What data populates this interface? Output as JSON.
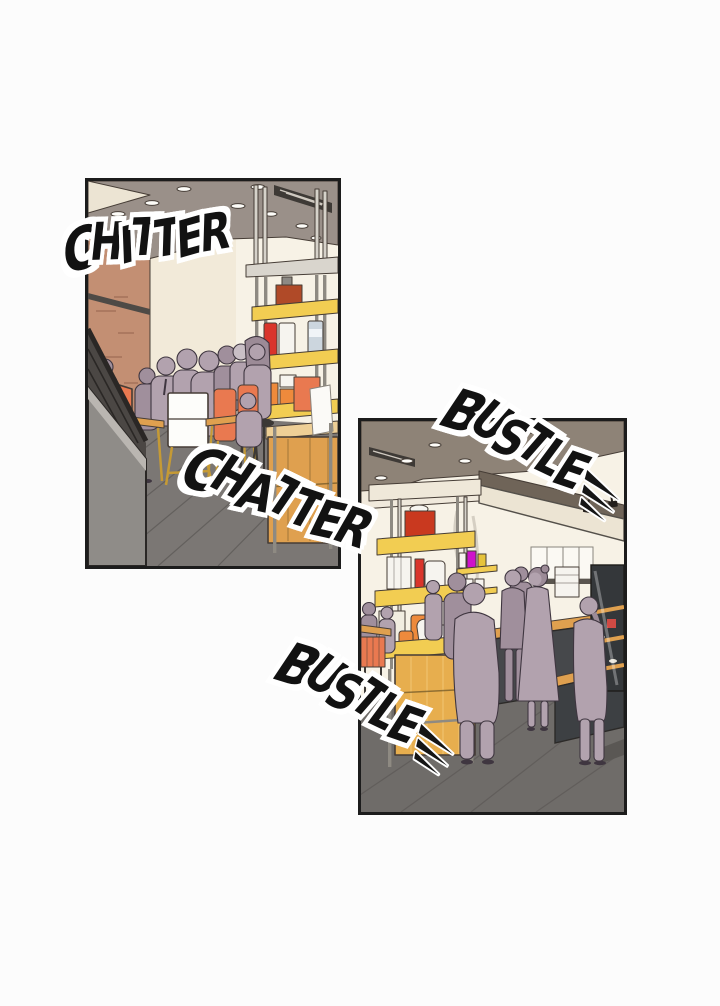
{
  "page": {
    "background": "#fcfcfc"
  },
  "panels": [
    {
      "id": "seating",
      "sfx_top": "CHITTER",
      "sfx_bottom": "CHATTER"
    },
    {
      "id": "counter",
      "sfx_top": "BUSTLE",
      "sfx_bottom": "BUSTLE"
    }
  ],
  "icons": {
    "speed_lines": "speed-lines-icon",
    "spotlight": "spotlight-icon"
  },
  "palette": {
    "page_bg": "#fcfcfc",
    "ink": "#1c1c1c",
    "line": "#463d36",
    "ceilA": "#9a9089",
    "ceilB": "#8e8377",
    "brick": "#c38f73",
    "brickline": "#9c6b53",
    "cream": "#f2ead9",
    "creamlight": "#f7f2e6",
    "beam": "#ece4d3",
    "vent": "#3e3a36",
    "floorA": "#7b7774",
    "floorB": "#6f6c69",
    "floorline": "#5e5a57",
    "people": "#b2a2ae",
    "peopledark": "#a08f9c",
    "peopleline": "#3f3640",
    "hairgray": "#c9bfc6",
    "hairplum": "#9c8b97",
    "orange": "#e97950",
    "wood": "#dfa04f",
    "woodlight": "#eecf96",
    "wooddark": "#6b5426",
    "yellow": "#f2cd52",
    "poleL": "#d6d2ca",
    "poleD": "#8e8a82",
    "red": "#d9352b",
    "reddark": "#b04a28",
    "bluegray": "#ccd6de",
    "orangeitem": "#ee8a3c",
    "magenta": "#cf12cb",
    "whiteitem": "#f6f4ef",
    "counterdark": "#46484b",
    "counterdark2": "#3d4043",
    "rail": "#2a2725",
    "balwall": "#8f8c88",
    "brass": "#c59a35",
    "white": "#fdfdfa",
    "machine": "#4c4741",
    "lightfix": "#fdfcf8"
  }
}
